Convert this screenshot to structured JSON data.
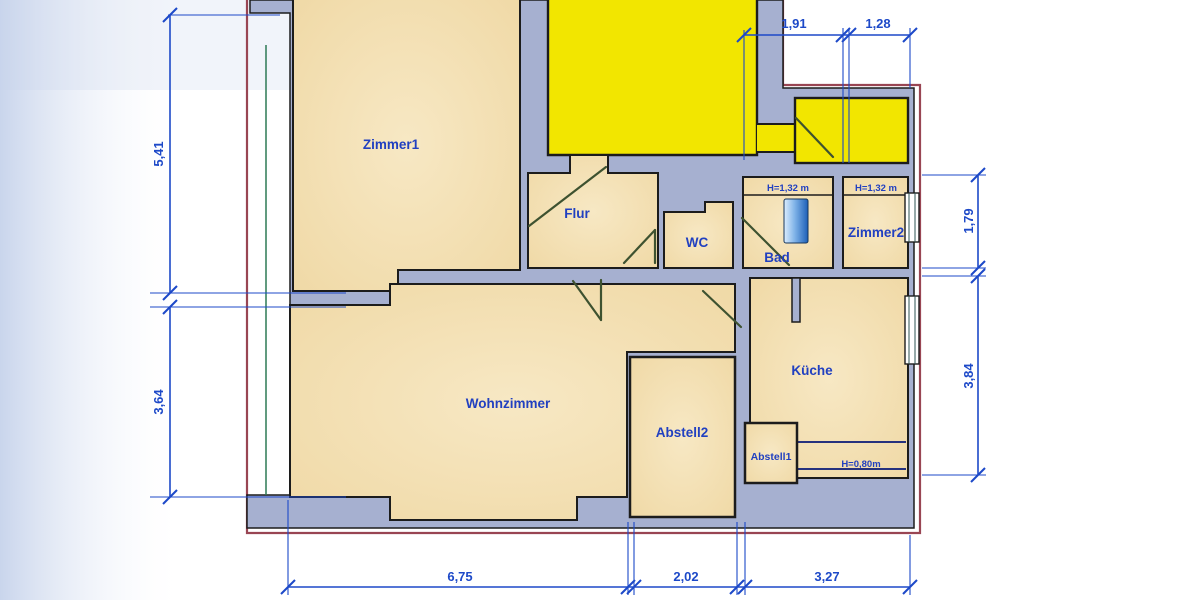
{
  "rooms": {
    "zimmer1": {
      "label": "Zimmer1"
    },
    "flur": {
      "label": "Flur"
    },
    "wc": {
      "label": "WC"
    },
    "bad": {
      "label": "Bad",
      "height_note": "H=1,32 m"
    },
    "zimmer2": {
      "label": "Zimmer2",
      "height_note": "H=1,32 m"
    },
    "wohnzimmer": {
      "label": "Wohnzimmer"
    },
    "abstell2": {
      "label": "Abstell2"
    },
    "abstell1": {
      "label": "Abstell1"
    },
    "kueche": {
      "label": "Küche",
      "counter_height_note": "H=0,80m"
    }
  },
  "dimensions": {
    "left_top": "5,41",
    "left_bottom": "3,64",
    "top_left": "1,91",
    "top_right": "1,28",
    "right_top": "1,79",
    "right_bottom": "3,84",
    "bottom_left": "6,75",
    "bottom_middle": "2,02",
    "bottom_right": "3,27"
  },
  "colors": {
    "wall_fill": "#a6b0d0",
    "room_fill": "#f3ddae",
    "highlight_fill": "#f2e600",
    "dimension_blue": "#1d49c8",
    "label_blue": "#2140c0",
    "boundary_maroon": "#994553",
    "door_green": "#3e5230",
    "outline_black": "#1c1c1c",
    "scan_green": "#2d7a55"
  }
}
